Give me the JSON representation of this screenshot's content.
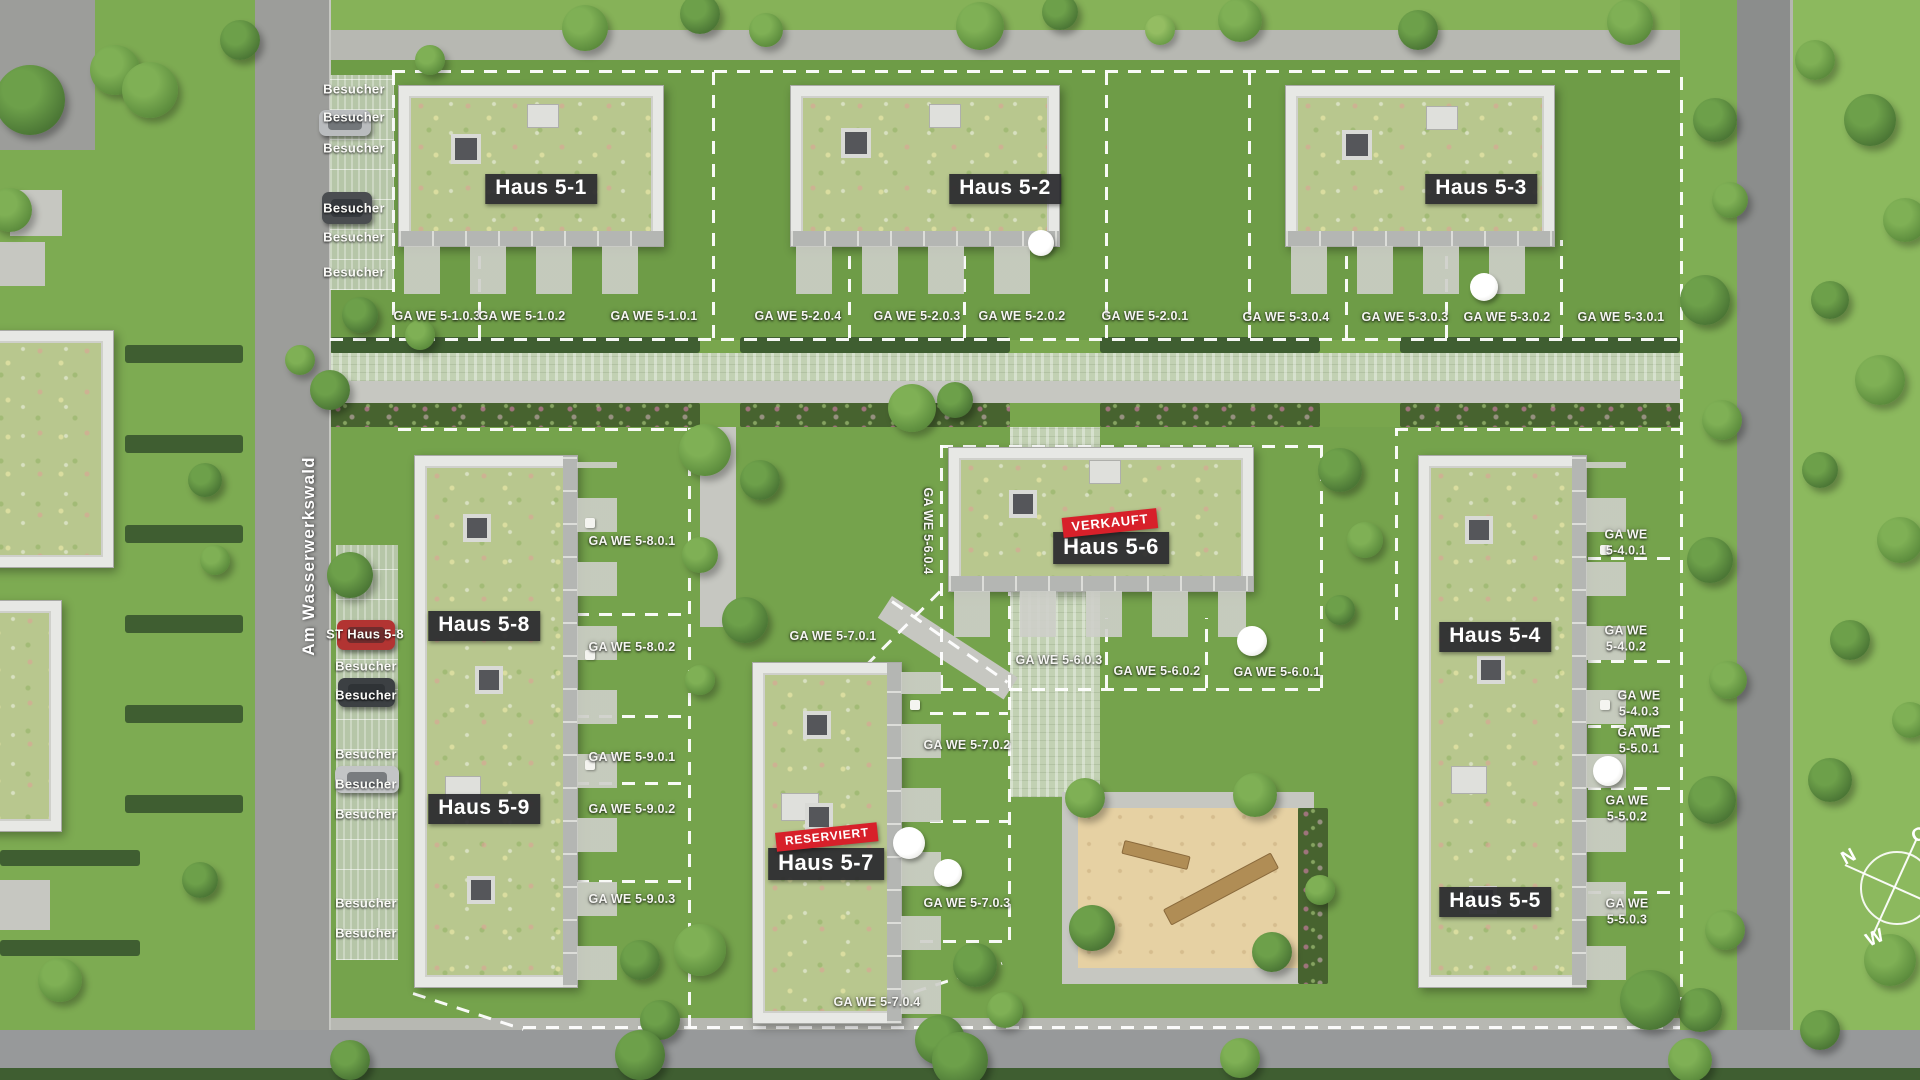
{
  "title": "Lageplan Wohnquartier Haus 5",
  "street_label": "Am Wasserwerkswald",
  "visitor_label": "Besucher",
  "st_parking_label": "ST Haus 5-8",
  "compass": {
    "n": "N",
    "w": "W",
    "o": "O"
  },
  "colors": {
    "badge_bg": "#2a2a2e",
    "flag_red": "#d7202a",
    "dash_white": "#ffffff",
    "roof_green": "#b8c78e",
    "sand": "#e6d1a3"
  },
  "houses": [
    {
      "label": "Haus 5-1",
      "x": 541,
      "y": 189,
      "status": ""
    },
    {
      "label": "Haus 5-2",
      "x": 1005,
      "y": 189,
      "status": ""
    },
    {
      "label": "Haus 5-3",
      "x": 1481,
      "y": 189,
      "status": ""
    },
    {
      "label": "Haus 5-8",
      "x": 484,
      "y": 626,
      "status": ""
    },
    {
      "label": "Haus 5-9",
      "x": 484,
      "y": 809,
      "status": ""
    },
    {
      "label": "Haus 5-6",
      "x": 1111,
      "y": 548,
      "status": "VERKAUFT",
      "sx": 1110,
      "sy": 523
    },
    {
      "label": "Haus 5-7",
      "x": 826,
      "y": 864,
      "status": "RESERVIERT",
      "sx": 827,
      "sy": 837
    },
    {
      "label": "Haus 5-4",
      "x": 1495,
      "y": 637,
      "status": ""
    },
    {
      "label": "Haus 5-5",
      "x": 1495,
      "y": 902,
      "status": ""
    }
  ],
  "plots": [
    {
      "label": "GA WE 5-1.0.3",
      "x": 437,
      "y": 317
    },
    {
      "label": "GA WE 5-1.0.2",
      "x": 522,
      "y": 317
    },
    {
      "label": "GA WE 5-1.0.1",
      "x": 654,
      "y": 317
    },
    {
      "label": "GA WE 5-2.0.4",
      "x": 798,
      "y": 317
    },
    {
      "label": "GA WE 5-2.0.3",
      "x": 917,
      "y": 317
    },
    {
      "label": "GA WE 5-2.0.2",
      "x": 1022,
      "y": 317
    },
    {
      "label": "GA WE 5-2.0.1",
      "x": 1145,
      "y": 317
    },
    {
      "label": "GA WE 5-3.0.4",
      "x": 1286,
      "y": 318
    },
    {
      "label": "GA WE 5-3.0.3",
      "x": 1405,
      "y": 318
    },
    {
      "label": "GA WE 5-3.0.2",
      "x": 1507,
      "y": 318
    },
    {
      "label": "GA WE 5-3.0.1",
      "x": 1621,
      "y": 318
    },
    {
      "label": "GA WE 5-8.0.1",
      "x": 632,
      "y": 542
    },
    {
      "label": "GA WE 5-8.0.2",
      "x": 632,
      "y": 648
    },
    {
      "label": "GA WE 5-9.0.1",
      "x": 632,
      "y": 758
    },
    {
      "label": "GA WE 5-9.0.2",
      "x": 632,
      "y": 810
    },
    {
      "label": "GA WE 5-9.0.3",
      "x": 632,
      "y": 900
    },
    {
      "label": "GA WE 5-7.0.1",
      "x": 833,
      "y": 637
    },
    {
      "label": "GA WE 5-7.0.2",
      "x": 967,
      "y": 746
    },
    {
      "label": "GA WE 5-7.0.3",
      "x": 967,
      "y": 904
    },
    {
      "label": "GA WE 5-7.0.4",
      "x": 877,
      "y": 1003
    },
    {
      "label": "GA WE 5-6.0.4",
      "x": 927,
      "y": 531,
      "rot": 90
    },
    {
      "label": "GA WE 5-6.0.3",
      "x": 1059,
      "y": 661
    },
    {
      "label": "GA WE 5-6.0.2",
      "x": 1157,
      "y": 672
    },
    {
      "label": "GA WE 5-6.0.1",
      "x": 1277,
      "y": 673
    },
    {
      "label": "GA WE\n5-4.0.1",
      "x": 1626,
      "y": 543
    },
    {
      "label": "GA WE\n5-4.0.2",
      "x": 1626,
      "y": 639
    },
    {
      "label": "GA WE\n5-4.0.3",
      "x": 1639,
      "y": 704
    },
    {
      "label": "GA WE\n5-5.0.1",
      "x": 1639,
      "y": 741
    },
    {
      "label": "GA WE\n5-5.0.2",
      "x": 1627,
      "y": 809
    },
    {
      "label": "GA WE\n5-5.0.3",
      "x": 1627,
      "y": 912
    }
  ],
  "visitor_spots": [
    {
      "x": 354,
      "y": 89
    },
    {
      "x": 354,
      "y": 117
    },
    {
      "x": 354,
      "y": 148
    },
    {
      "x": 354,
      "y": 208
    },
    {
      "x": 354,
      "y": 237
    },
    {
      "x": 354,
      "y": 272
    },
    {
      "x": 366,
      "y": 666
    },
    {
      "x": 366,
      "y": 695
    },
    {
      "x": 366,
      "y": 754
    },
    {
      "x": 366,
      "y": 784
    },
    {
      "x": 366,
      "y": 814
    },
    {
      "x": 366,
      "y": 903
    },
    {
      "x": 366,
      "y": 933
    }
  ],
  "st_spot": {
    "x": 365,
    "y": 634
  }
}
